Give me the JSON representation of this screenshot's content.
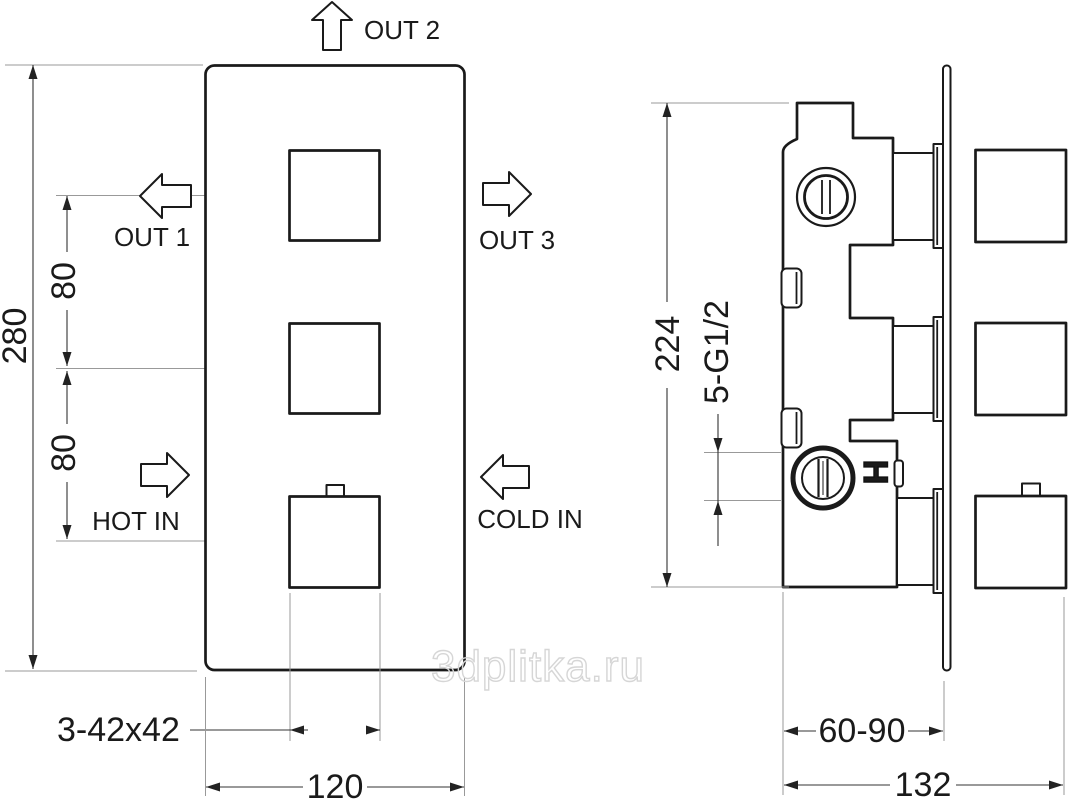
{
  "watermark": "3dplitka.ru",
  "front_view": {
    "flow_labels": {
      "out2": "OUT 2",
      "out1": "OUT 1",
      "out3": "OUT 3",
      "hot_in": "HOT IN",
      "cold_in": "COLD IN"
    },
    "dimensions": {
      "height": "280",
      "port_spacing_upper": "80",
      "port_spacing_lower": "80",
      "knob_size": "3-42x42",
      "width": "120"
    }
  },
  "side_view": {
    "dimensions": {
      "height": "224",
      "thread_ports": "5-G1/2",
      "mounting_depth": "60-90",
      "total_depth": "132"
    },
    "hot_marking": "H"
  },
  "icons": {
    "out2_arrow": "arrow-up-outline",
    "out1_arrow": "arrow-left-outline",
    "out3_arrow": "arrow-right-outline",
    "hot_in_arrow": "arrow-right-outline",
    "cold_in_arrow": "arrow-left-outline"
  },
  "colors": {
    "line": "#1a1a1a",
    "dimension": "#333333",
    "construction": "#999999",
    "watermark": "#d6d6d6",
    "background": "#ffffff"
  }
}
